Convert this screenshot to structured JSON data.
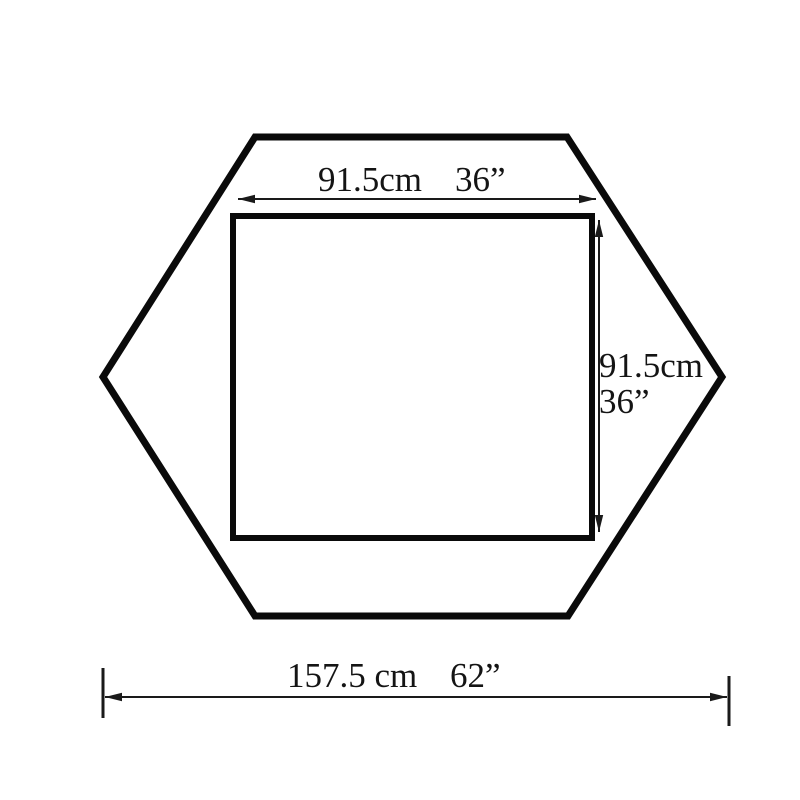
{
  "diagram": {
    "background_color": "#ffffff",
    "line_color": "#0a0a0a",
    "shape": "hexagon-with-inner-square",
    "dimensions": {
      "top": {
        "metric": "91.5cm",
        "imperial": "36”"
      },
      "right": {
        "metric": "91.5cm",
        "imperial": "36”"
      },
      "bottom": {
        "metric": "157.5 cm",
        "imperial": "62”"
      }
    }
  }
}
